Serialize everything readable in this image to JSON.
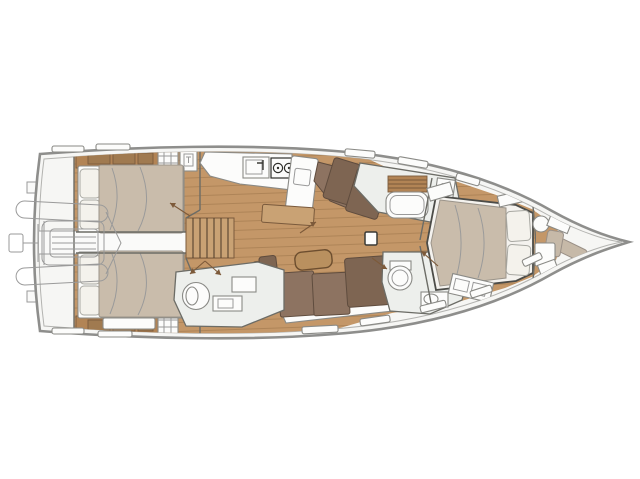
{
  "title": "Sailing yacht interior deck layout plan, top view, bow pointing right",
  "diagram": {
    "type": "floor-plan",
    "subject": "sailboat-interior-layout",
    "orientation": "bow-right-stern-left",
    "areas": [
      {
        "name": "stern-swim-platform",
        "features": [
          "transom-steps",
          "tender-garage"
        ]
      },
      {
        "name": "tender-dinghy-outline",
        "features": [
          "inflatable-tubes",
          "outboard-motor"
        ]
      },
      {
        "name": "aft-cabin-port",
        "features": [
          "double-bed",
          "two-pillows",
          "shelf-with-lockers",
          "wardrobe-grid",
          "washbasin"
        ]
      },
      {
        "name": "aft-cabin-starboard",
        "features": [
          "double-bed",
          "two-pillows",
          "shelf-with-lockers",
          "wardrobe-grid",
          "bench"
        ]
      },
      {
        "name": "companionway",
        "features": [
          "stairs",
          "door-swing-arrows"
        ]
      },
      {
        "name": "galley",
        "features": [
          "sink-with-faucet",
          "two-burner-stove",
          "island-counter",
          "bench-seat"
        ]
      },
      {
        "name": "salon",
        "features": [
          "corner-sofa-starboard",
          "l-shaped-sofa-port",
          "coffee-table",
          "stool",
          "mast-base"
        ]
      },
      {
        "name": "aft-head",
        "features": [
          "shower",
          "washbasin",
          "toilet"
        ]
      },
      {
        "name": "day-head",
        "features": [
          "round-washbasin",
          "toilet",
          "locker"
        ]
      },
      {
        "name": "forward-head",
        "features": [
          "bathtub",
          "slatted-shelf",
          "washbasin"
        ]
      },
      {
        "name": "forward-cabin",
        "features": [
          "island-double-bed",
          "two-pillows",
          "vanity",
          "overhead-lockers"
        ]
      },
      {
        "name": "bow-lounge",
        "features": [
          "corner-seat",
          "round-washbasin",
          "vanity"
        ]
      },
      {
        "name": "deck",
        "features": [
          "deck-hatches",
          "side-decks",
          "hull-double-outline"
        ]
      }
    ]
  },
  "colors": {
    "deck": "#f6f6f4",
    "hull_outline": "#8e8e8c",
    "hull_inner_line": "#b3b3b0",
    "wood_floor": "#c49768",
    "plank_line": "rgba(122,86,50,0.45)",
    "wood_trim": "#b28455",
    "wood_box": "#a07a50",
    "wood_edge": "#7a5a3c",
    "bench": "#c9a274",
    "mattress": "#c9bcab",
    "mattress_edge": "#9b948a",
    "pillow": "#f4f2ec",
    "pillow_edge": "#a8a8a2",
    "fixture": "#fcfcfb",
    "fixture_edge": "#8a8a86",
    "bath_floor": "#edefec",
    "sofa": "#8d7361",
    "sofa_dark": "#7e6552",
    "sofa_edge": "#5f4c3e",
    "beige_seat": "#c6b9a8",
    "beige_edge": "#9a9087",
    "wall": "#6c6c66",
    "thin_line": "#9a9a9a",
    "arrow": "#7d5a3a",
    "table": "#b9905f",
    "table_edge": "#6d4e2f"
  }
}
